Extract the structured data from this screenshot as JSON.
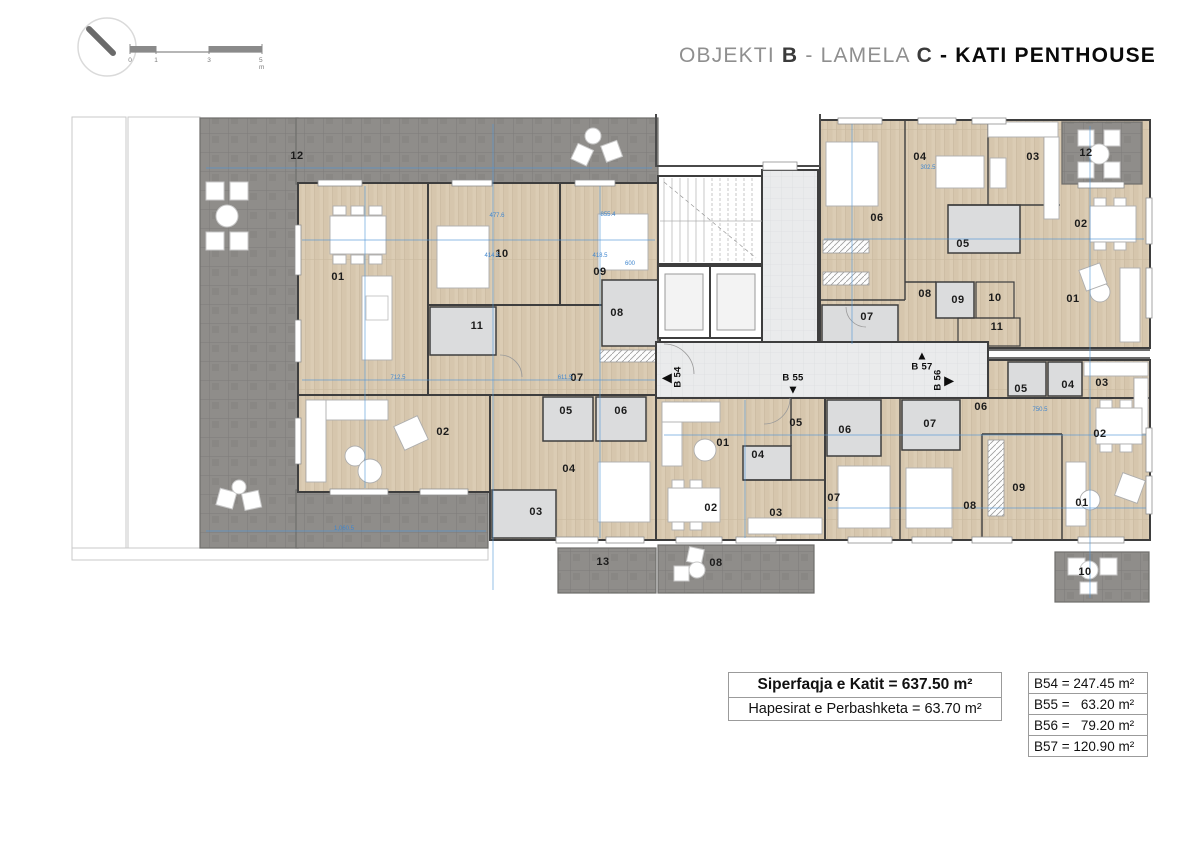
{
  "header": {
    "title": {
      "objekti": "OBJEKTI",
      "objekti_value": "B",
      "dash1": "-",
      "lamela": "LAMELA",
      "lamela_value": "C",
      "dash2": "-",
      "floor": "KATI PENTHOUSE"
    },
    "scale_ticks": [
      "0",
      "1",
      "3",
      "5 m"
    ]
  },
  "plan": {
    "unit_markers": [
      {
        "label": "B 54",
        "dir": "left",
        "x": 673,
        "y": 377
      },
      {
        "label": "B 55",
        "dir": "down",
        "x": 793,
        "y": 384
      },
      {
        "label": "B 57",
        "dir": "up",
        "x": 922,
        "y": 361
      },
      {
        "label": "B 56",
        "dir": "right",
        "x": 943,
        "y": 380
      }
    ],
    "room_labels": [
      {
        "text": "12",
        "x": 297,
        "y": 156
      },
      {
        "text": "01",
        "x": 338,
        "y": 277
      },
      {
        "text": "10",
        "x": 502,
        "y": 254
      },
      {
        "text": "09",
        "x": 600,
        "y": 272
      },
      {
        "text": "08",
        "x": 617,
        "y": 313
      },
      {
        "text": "11",
        "x": 477,
        "y": 326
      },
      {
        "text": "07",
        "x": 577,
        "y": 378
      },
      {
        "text": "02",
        "x": 443,
        "y": 432
      },
      {
        "text": "05",
        "x": 566,
        "y": 411
      },
      {
        "text": "06",
        "x": 621,
        "y": 411
      },
      {
        "text": "04",
        "x": 569,
        "y": 469
      },
      {
        "text": "03",
        "x": 536,
        "y": 512
      },
      {
        "text": "13",
        "x": 603,
        "y": 562
      },
      {
        "text": "01",
        "x": 723,
        "y": 443
      },
      {
        "text": "04",
        "x": 758,
        "y": 455
      },
      {
        "text": "05",
        "x": 796,
        "y": 423
      },
      {
        "text": "02",
        "x": 711,
        "y": 508
      },
      {
        "text": "03",
        "x": 776,
        "y": 513
      },
      {
        "text": "08",
        "x": 716,
        "y": 563
      },
      {
        "text": "06",
        "x": 845,
        "y": 430
      },
      {
        "text": "07",
        "x": 930,
        "y": 424
      },
      {
        "text": "07",
        "x": 834,
        "y": 498
      },
      {
        "text": "06",
        "x": 981,
        "y": 407
      },
      {
        "text": "05",
        "x": 1021,
        "y": 389
      },
      {
        "text": "04",
        "x": 1068,
        "y": 385
      },
      {
        "text": "03",
        "x": 1102,
        "y": 383
      },
      {
        "text": "02",
        "x": 1100,
        "y": 434
      },
      {
        "text": "08",
        "x": 970,
        "y": 506
      },
      {
        "text": "09",
        "x": 1019,
        "y": 488
      },
      {
        "text": "01",
        "x": 1082,
        "y": 503
      },
      {
        "text": "10",
        "x": 1085,
        "y": 572
      },
      {
        "text": "06",
        "x": 877,
        "y": 218
      },
      {
        "text": "04",
        "x": 920,
        "y": 157
      },
      {
        "text": "03",
        "x": 1033,
        "y": 157
      },
      {
        "text": "12",
        "x": 1086,
        "y": 153
      },
      {
        "text": "02",
        "x": 1081,
        "y": 224
      },
      {
        "text": "05",
        "x": 963,
        "y": 244
      },
      {
        "text": "08",
        "x": 925,
        "y": 294
      },
      {
        "text": "09",
        "x": 958,
        "y": 300
      },
      {
        "text": "10",
        "x": 995,
        "y": 298
      },
      {
        "text": "11",
        "x": 997,
        "y": 327
      },
      {
        "text": "07",
        "x": 867,
        "y": 317
      },
      {
        "text": "01",
        "x": 1073,
        "y": 299
      }
    ],
    "dim_labels": [
      {
        "text": "712.5",
        "x": 398,
        "y": 378
      },
      {
        "text": "611.5",
        "x": 565,
        "y": 378
      },
      {
        "text": "477.6",
        "x": 497,
        "y": 216
      },
      {
        "text": "414.5",
        "x": 492,
        "y": 256
      },
      {
        "text": "418.5",
        "x": 600,
        "y": 256
      },
      {
        "text": "855.4",
        "x": 608,
        "y": 215
      },
      {
        "text": "600",
        "x": 630,
        "y": 264
      },
      {
        "text": "1,060.5",
        "x": 344,
        "y": 529
      },
      {
        "text": "302.5",
        "x": 928,
        "y": 168
      },
      {
        "text": "750.5",
        "x": 1040,
        "y": 410
      }
    ]
  },
  "summary_table": {
    "rows": [
      {
        "text": "Siperfaqja e Katit = 637.50 m²"
      },
      {
        "text": "Hapesirat e Perbashketa  = 63.70 m²"
      }
    ]
  },
  "units_table": {
    "rows": [
      "B54 = 247.45 m²",
      "B55 =   63.20 m²",
      "B56 =   79.20 m²",
      "B57 = 120.90 m²"
    ]
  }
}
